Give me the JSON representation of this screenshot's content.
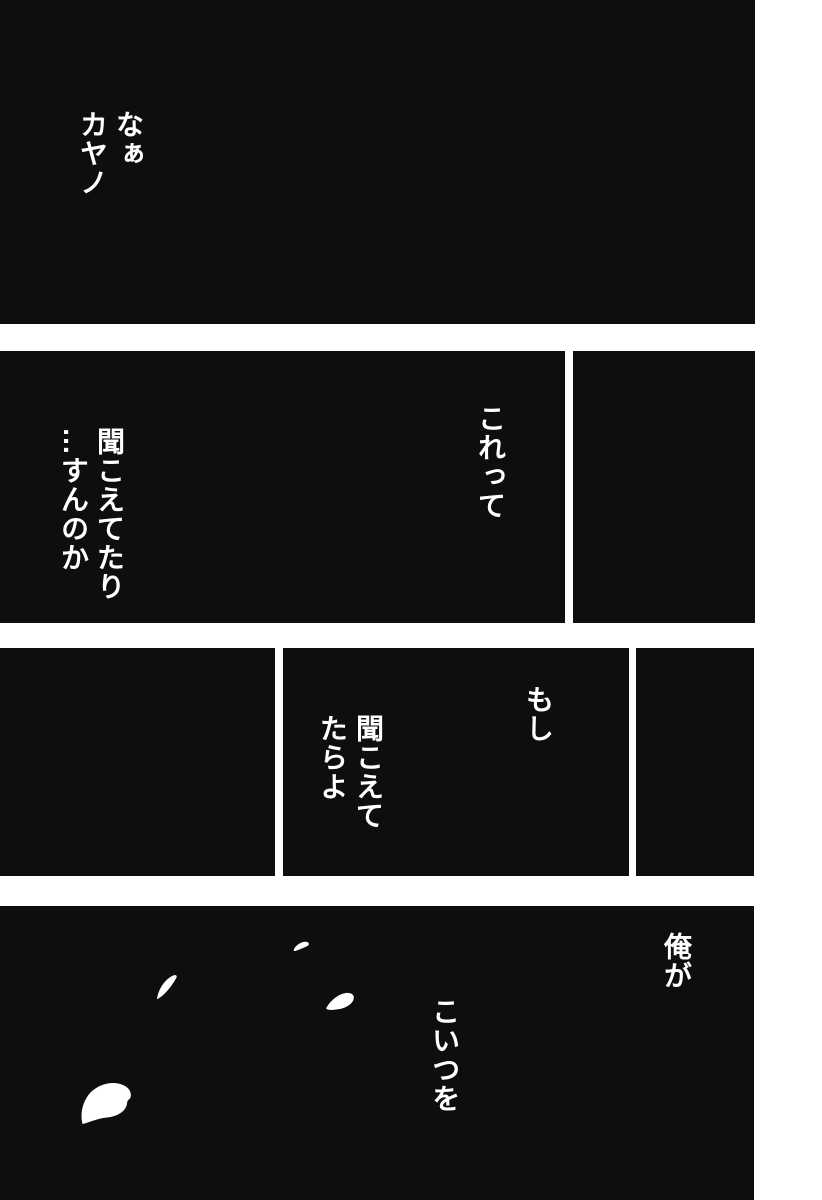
{
  "colors": {
    "bg": "#ffffff",
    "panel": "#0e0e0e",
    "text": "#ffffff"
  },
  "speech": {
    "b1": {
      "lines": [
        "なぁ",
        "カヤノ"
      ]
    },
    "b2": {
      "lines": [
        "これって"
      ]
    },
    "b3": {
      "lines": [
        "聞こえてたり",
        "…すんのか"
      ]
    },
    "b4": {
      "lines": [
        "もし"
      ]
    },
    "b5": {
      "lines": [
        "聞こえて",
        "たらよ"
      ]
    },
    "b6": {
      "lines": [
        "俺が"
      ]
    },
    "b7": {
      "lines": [
        "こいつを"
      ]
    }
  },
  "icons": {
    "petals": [
      "petal-icon",
      "petal-icon",
      "petal-icon",
      "petal-icon"
    ]
  }
}
